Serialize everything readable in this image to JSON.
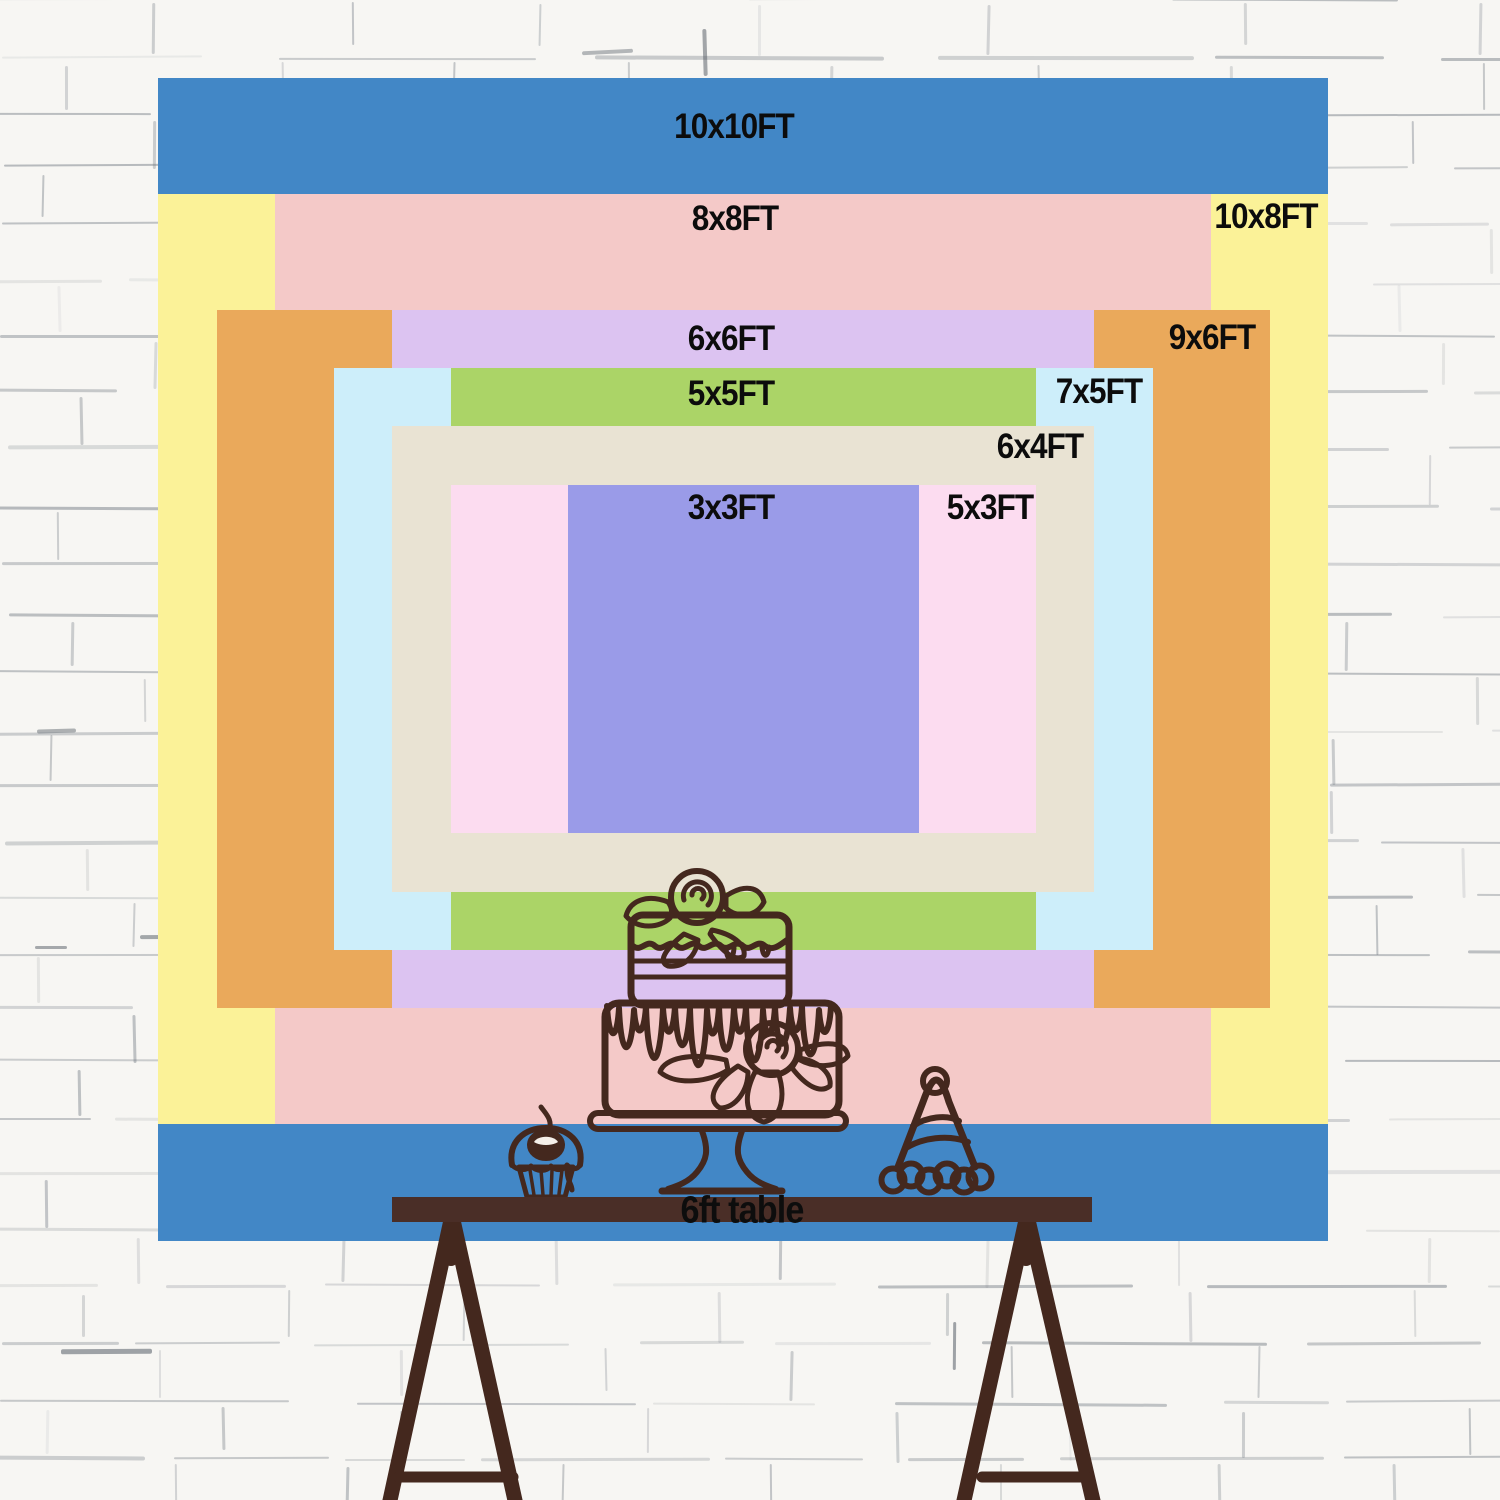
{
  "page": {
    "type": "backdrop-size-chart",
    "unit": "FT"
  },
  "wall": {
    "base_color": "#f7f6f3",
    "mortar_color": "#6f7780"
  },
  "geometry": {
    "center_x": 743,
    "center_y": 659,
    "px_per_ft_x": 117,
    "px_per_ft_y": 116.3
  },
  "sizes": [
    {
      "id": "10x10",
      "label": "10x10FT",
      "w_ft": 10,
      "h_ft": 10,
      "color": "#4287c6",
      "label_x": 734,
      "label_y": 127
    },
    {
      "id": "10x8",
      "label": "10x8FT",
      "w_ft": 10,
      "h_ft": 8,
      "color": "#fbf298",
      "label_x": 1266,
      "label_y": 217
    },
    {
      "id": "8x8",
      "label": "8x8FT",
      "w_ft": 8,
      "h_ft": 8,
      "color": "#f4c9c8",
      "label_x": 735,
      "label_y": 219
    },
    {
      "id": "9x6",
      "label": "9x6FT",
      "w_ft": 9,
      "h_ft": 6,
      "color": "#eaa95b",
      "label_x": 1212,
      "label_y": 338
    },
    {
      "id": "6x6",
      "label": "6x6FT",
      "w_ft": 6,
      "h_ft": 6,
      "color": "#dcc3f1",
      "label_x": 731,
      "label_y": 339
    },
    {
      "id": "7x5",
      "label": "7x5FT",
      "w_ft": 7,
      "h_ft": 5,
      "color": "#cdeefa",
      "label_x": 1099,
      "label_y": 392
    },
    {
      "id": "5x5",
      "label": "5x5FT",
      "w_ft": 5,
      "h_ft": 5,
      "color": "#abd467",
      "label_x": 731,
      "label_y": 394
    },
    {
      "id": "6x4",
      "label": "6x4FT",
      "w_ft": 6,
      "h_ft": 4,
      "color": "#e9e3d3",
      "label_x": 1040,
      "label_y": 447
    },
    {
      "id": "5x3",
      "label": "5x3FT",
      "w_ft": 5,
      "h_ft": 3,
      "color": "#fcdcf0",
      "label_x": 990,
      "label_y": 508
    },
    {
      "id": "3x3",
      "label": "3x3FT",
      "w_ft": 3,
      "h_ft": 3,
      "color": "#9a9be8",
      "label_x": 731,
      "label_y": 508
    }
  ],
  "table": {
    "label": "6ft table",
    "length_ft": 6,
    "bar_color": "#4a2e27",
    "label_color": "#0d0d0d"
  },
  "illustration": {
    "ink_color": "#44281e",
    "items": [
      "cupcake",
      "two-tier-cake",
      "party-hat"
    ]
  }
}
